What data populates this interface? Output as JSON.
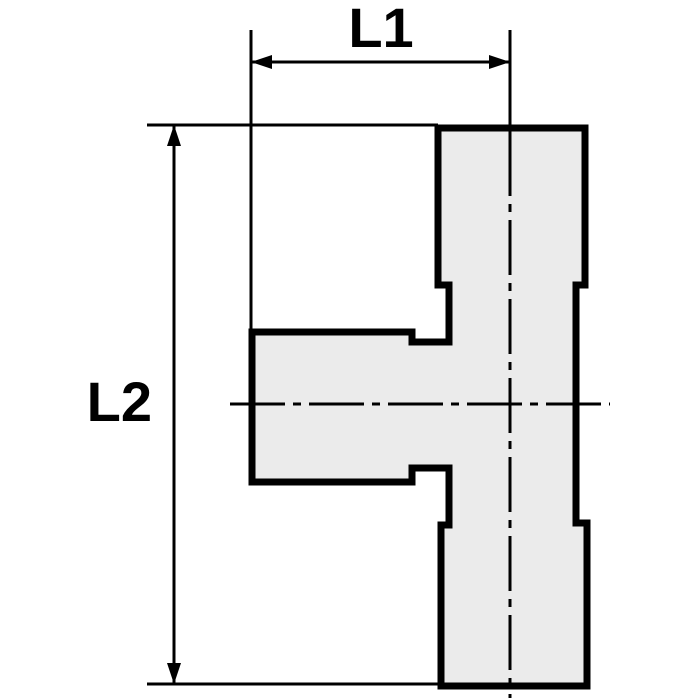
{
  "drawing": {
    "kind": "tee-fitting-dimension-drawing",
    "dimensions": {
      "l1": {
        "label": "L1"
      },
      "l2": {
        "label": "L2"
      }
    }
  },
  "colors": {
    "background": "#ffffff",
    "fitting_fill": "#ebebeb",
    "line_color": "#000000"
  }
}
